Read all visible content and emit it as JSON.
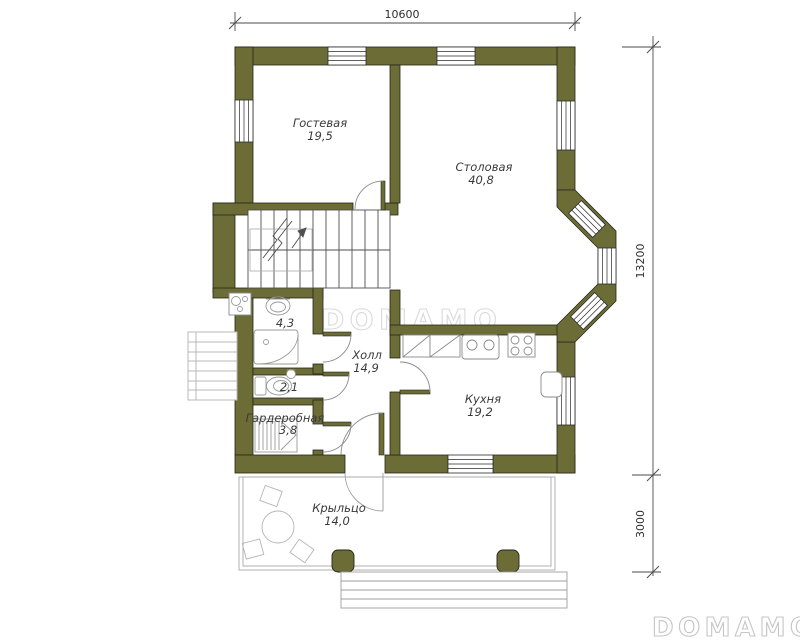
{
  "document": {
    "type": "floor-plan",
    "background": "#ffffff"
  },
  "watermarks": {
    "center": "DOMAMO",
    "corner": "DOMAMO"
  },
  "dimensions": {
    "overall_width": "10600",
    "overall_depth": "13200",
    "porch_depth": "3000"
  },
  "rooms": {
    "guest": {
      "name": "Гостевая",
      "area": "19,5"
    },
    "dining": {
      "name": "Столовая",
      "area": "40,8"
    },
    "hall": {
      "name": "Холл",
      "area": "14,9"
    },
    "kitchen": {
      "name": "Кухня",
      "area": "19,2"
    },
    "bathroom": {
      "area": "4,3"
    },
    "wc": {
      "area": "2,1"
    },
    "wardrobe": {
      "name": "Гардеробная",
      "area": "3,8"
    },
    "porch": {
      "name": "Крыльцо",
      "area": "14,0"
    }
  },
  "colors": {
    "wall": "#6b6c36",
    "wall_outline": "#26261a",
    "fixture_line": "#999999",
    "dimension_line": "#4a4a4a",
    "label_text": "#3a3a3a",
    "watermark_center": "#dadada",
    "watermark_corner": "#c6c6c6"
  }
}
